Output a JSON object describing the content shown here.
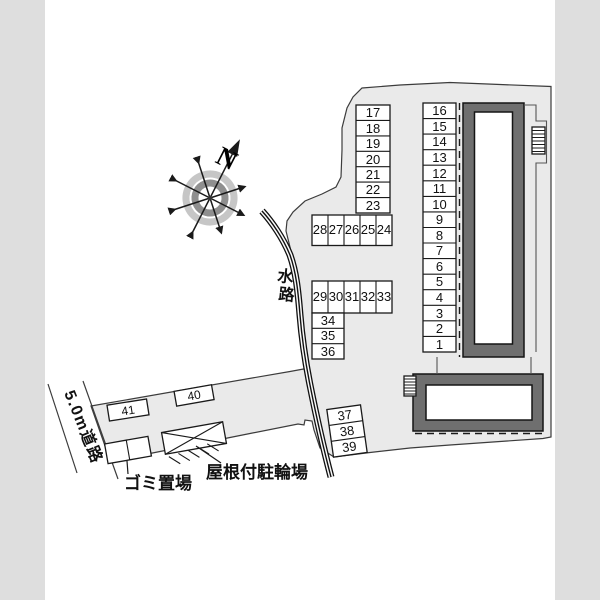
{
  "page": {
    "background": "#dedede",
    "paper": "#ffffff"
  },
  "colors": {
    "site_fill": "#eaeaea",
    "outline": "#3c3c3c",
    "building_frame": "#6f6f6f",
    "line": "#1a1a1a",
    "compass_ring_outer": "#c6c6c6",
    "compass_ring_inner": "#8f8f8f"
  },
  "compass": {
    "north_label": "N"
  },
  "labels": {
    "waterway": "水路",
    "waterway_chars": [
      "水",
      "路"
    ],
    "road": "5.0m道路",
    "garbage": "ゴミ置場",
    "bicycle_shed": "屋根付駐輪場"
  },
  "parking": {
    "col_a": [
      "17",
      "18",
      "19",
      "20",
      "21",
      "22",
      "23"
    ],
    "col_b": [
      "16",
      "15",
      "14",
      "13",
      "12",
      "11",
      "10",
      "9",
      "8",
      "7",
      "6",
      "5",
      "4",
      "3",
      "2",
      "1"
    ],
    "row_upper": [
      "28",
      "27",
      "26",
      "25",
      "24"
    ],
    "row_lower": [
      "29",
      "30",
      "31",
      "32",
      "33"
    ],
    "col_c": [
      "34",
      "35",
      "36"
    ],
    "col_d": [
      "37",
      "38",
      "39"
    ],
    "space_40": "40",
    "space_41": "41"
  }
}
